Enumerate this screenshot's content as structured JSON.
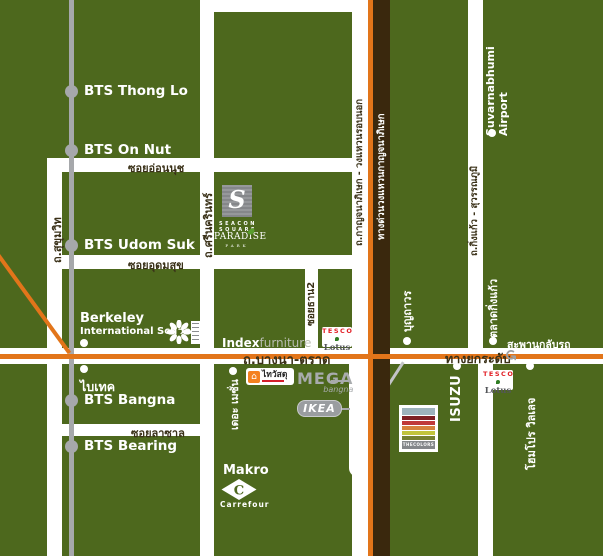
{
  "colors": {
    "background": "#4d681d",
    "road_white": "#ffffff",
    "route_orange": "#e2751a",
    "expressway_brown": "#3a280d",
    "bts_gray": "#a6a8ab",
    "road_label_dark": "#3a3118",
    "label_white": "#ffffff"
  },
  "bts": {
    "stations": [
      {
        "label": "BTS Thong Lo"
      },
      {
        "label": "BTS On Nut"
      },
      {
        "label": "BTS Udom Suk"
      },
      {
        "label": "BTS Bangna"
      },
      {
        "label": "BTS Bearing"
      }
    ]
  },
  "road_labels": {
    "onnut": "ซอยอ่อนนุช",
    "udomsuk": "ซอยอุดมสุข",
    "lasalle": "ซอยลาซาล",
    "bangna_trad": "ถ.บางนา-ตราด",
    "sukhumvit": "ถ.สุขุมวิท",
    "srinakarin": "ถ.ศรีนครินทร์",
    "soi_than2": "ซอยธาน2",
    "ring_road": "ถ.กาญจนาภิเษก - วงแหวนรอบนอก",
    "expressway": "ทางด่วนวงแหวนกาญจนาภิเษก",
    "kingkaew": "ถ.กิ่งแก้ว - สุวรรณภูมิ",
    "elevated": "ทางยกระดับ"
  },
  "places": {
    "berkeley_line1": "Berkeley",
    "berkeley_line2": "International School",
    "bitec": "ไบเทค",
    "maison": "เดอะ เมซั่น",
    "boonthavorn": "บุญถาวร",
    "suvarnabhumi_line1": "Suvarnabhumi",
    "suvarnabhumi_line2": "Airport",
    "talad_kingkaew": "ตลาดกิ่งแก้ว",
    "u_turn_bridge": "สะพานกลับรถ",
    "homepro_village": "โฮมโปร วิลเลจ",
    "isuzu": "ISUZU",
    "makro": "Makro"
  },
  "logos": {
    "seacon_s": "S",
    "seacon_line1": "SEACON",
    "seacon_line2": "SQUARE",
    "paradise_line1": "PARADISE",
    "paradise_line2": "PARK",
    "index_bold": "Index",
    "index_light": "furniture",
    "tesco": "TESCO",
    "lotus": "Lotus",
    "mega": "MEGA",
    "mega_sub": "bangna",
    "ikea": "IKEA",
    "thaiwatsadu": "ไทวัสดุ",
    "thecolors": "THECOLORS",
    "carrefour": "Carrefour",
    "carrefour_c": "C"
  },
  "icons": {
    "u_turn": "↺",
    "house": "⌂"
  }
}
